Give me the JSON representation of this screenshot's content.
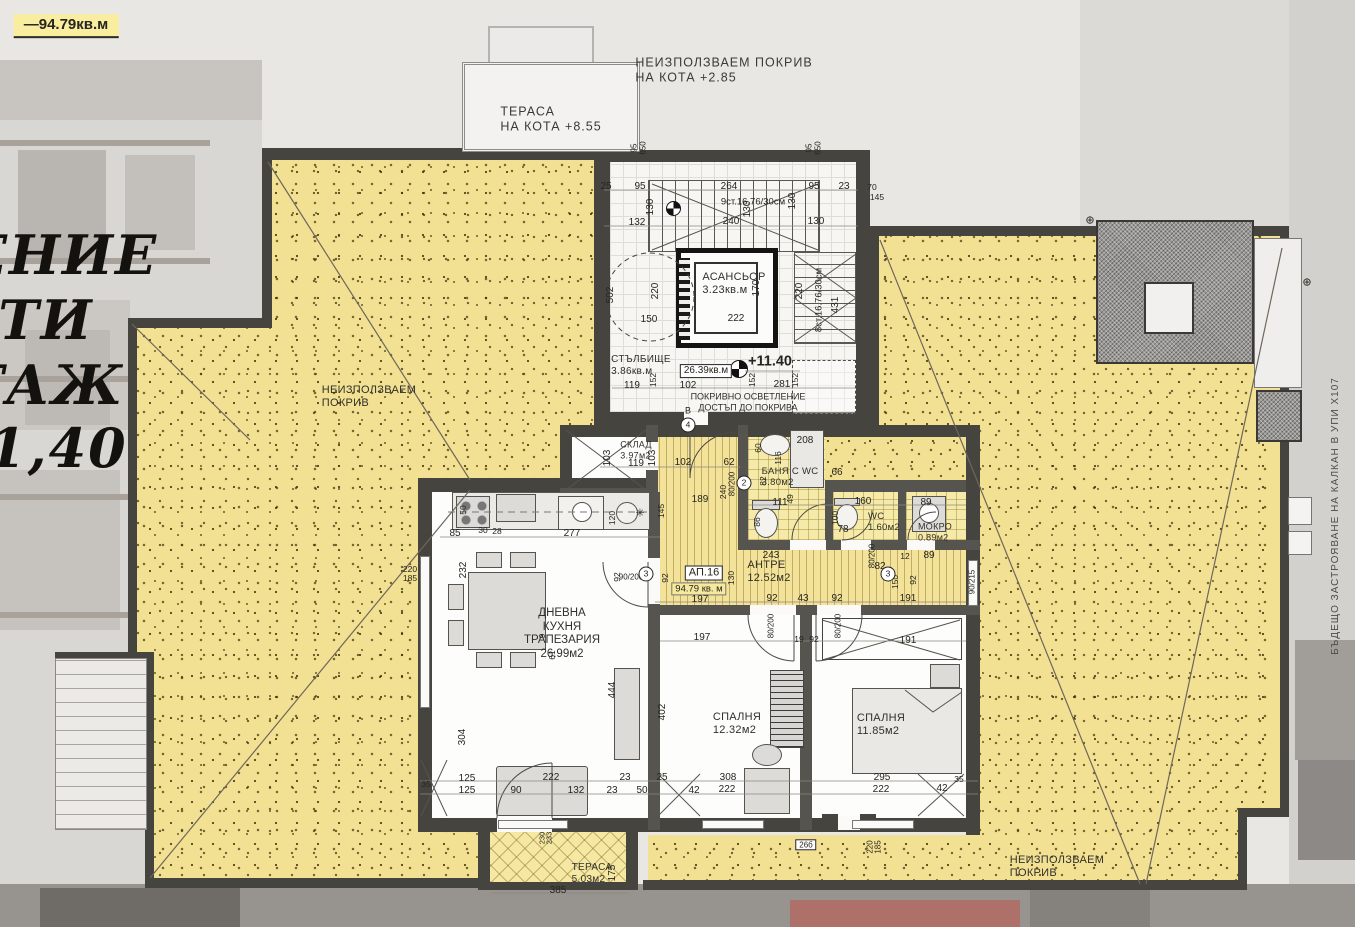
{
  "colors": {
    "roof_yellow": "#f2e193",
    "wall_dark": "#45443e",
    "highlight": "#f9eda0",
    "photo_gray": "#d9d7d4"
  },
  "texts": {
    "site": [
      {
        "t": "—94.79кв.м",
        "x": 66,
        "y": 26,
        "c": "hl",
        "n": "area-note"
      },
      {
        "t": "ЕНИЕ",
        "x": 62,
        "y": 256,
        "c": "big",
        "n": "decorative-text-fragment"
      },
      {
        "t": "ТИ",
        "x": 46,
        "y": 321,
        "c": "big",
        "n": "decorative-text-fragment"
      },
      {
        "t": "ТАЖ",
        "x": 44,
        "y": 386,
        "c": "big",
        "n": "decorative-text-fragment"
      },
      {
        "t": "1,40",
        "x": 58,
        "y": 449,
        "c": "big",
        "n": "decorative-text-fragment"
      },
      {
        "t": "ТЕРАСА\nНА КОТА +8.55",
        "x": 551,
        "y": 119,
        "c": "note",
        "n": "terrace-level-note"
      },
      {
        "t": "НЕИЗПОЛЗВАЕМ  ПОКРИВ\nНА КОТА +2.85",
        "x": 724,
        "y": 70,
        "c": "note",
        "n": "roof-level-note"
      },
      {
        "t": "НЕИЗПОЛЗВАЕМ\nПОКРИВ",
        "x": 369,
        "y": 397,
        "c": "room",
        "n": "roof-label-left"
      },
      {
        "t": "НЕИЗПОЛЗВАЕМ\nПОКРИВ",
        "x": 1057,
        "y": 867,
        "c": "room",
        "n": "roof-label-right"
      },
      {
        "t": "БЪДЕЩО  ЗАСТРОЯВАНЕ  НА  КАЛКАН  В  УПИ  Х107",
        "x": 1336,
        "y": 516,
        "r": -90,
        "c": "dimg",
        "n": "future-construction-note"
      },
      {
        "t": "⊕",
        "x": 1090,
        "y": 221,
        "s": 11
      },
      {
        "t": "⊕",
        "x": 1307,
        "y": 283,
        "s": 11
      }
    ],
    "core": [
      {
        "t": "АСАНСЬОР\n3.23кв.м",
        "x": 734,
        "y": 284,
        "c": "room",
        "n": "room-label-elevator"
      },
      {
        "t": "СТЪЛБИЩЕ\n3.86кв.м",
        "x": 641,
        "y": 366,
        "c": "room",
        "s": 10,
        "n": "room-label-stairs"
      },
      {
        "t": "26.39кв.м",
        "x": 706,
        "y": 371,
        "c": "box",
        "n": "core-area-box"
      },
      {
        "t": "+11.40",
        "x": 770,
        "y": 362,
        "c": "lvltxt",
        "n": "level-mark"
      },
      {
        "t": "ПОКРИВНО  ОСВЕТЛЕНИЕ\nДОСТЪП  ДО  ПОКРИВА",
        "x": 748,
        "y": 402,
        "c": "room-c",
        "s": 9,
        "n": "skylight-note"
      },
      {
        "t": "9ст.16.76/30см",
        "x": 753,
        "y": 202,
        "s": 9.5
      },
      {
        "t": "8ст.16.76/30см",
        "x": 819,
        "y": 300,
        "r": -90,
        "s": 9.5
      },
      {
        "t": "В",
        "x": 688,
        "y": 411,
        "s": 9
      },
      {
        "t": "4",
        "x": 688,
        "y": 425,
        "c": "circle"
      },
      {
        "t": "25",
        "x": 606,
        "y": 187
      },
      {
        "t": "95",
        "x": 640,
        "y": 187
      },
      {
        "t": "264",
        "x": 729,
        "y": 187
      },
      {
        "t": "95",
        "x": 814,
        "y": 187
      },
      {
        "t": "23",
        "x": 844,
        "y": 187
      },
      {
        "t": "70",
        "x": 872,
        "y": 187,
        "s": 8.5
      },
      {
        "t": "145",
        "x": 877,
        "y": 197,
        "s": 8.5
      },
      {
        "t": "130",
        "x": 651,
        "y": 207,
        "r": -90
      },
      {
        "t": "130",
        "x": 748,
        "y": 209,
        "r": -90
      },
      {
        "t": "130",
        "x": 793,
        "y": 201,
        "r": -90
      },
      {
        "t": "132",
        "x": 637,
        "y": 223
      },
      {
        "t": "240",
        "x": 731,
        "y": 222
      },
      {
        "t": "130",
        "x": 816,
        "y": 222
      },
      {
        "t": "95",
        "x": 634,
        "y": 148,
        "r": -90,
        "s": 8
      },
      {
        "t": "650",
        "x": 643,
        "y": 148,
        "r": -90,
        "s": 8
      },
      {
        "t": "95",
        "x": 809,
        "y": 148,
        "r": -90,
        "s": 8
      },
      {
        "t": "650",
        "x": 818,
        "y": 148,
        "r": -90,
        "s": 8
      },
      {
        "t": "502",
        "x": 611,
        "y": 295,
        "r": -90
      },
      {
        "t": "220",
        "x": 656,
        "y": 291,
        "r": -90
      },
      {
        "t": "150",
        "x": 649,
        "y": 320
      },
      {
        "t": "170",
        "x": 757,
        "y": 288,
        "r": -90
      },
      {
        "t": "222",
        "x": 736,
        "y": 319
      },
      {
        "t": "220",
        "x": 800,
        "y": 291,
        "r": -90
      },
      {
        "t": "431",
        "x": 836,
        "y": 305,
        "r": -90
      },
      {
        "t": "119",
        "x": 632,
        "y": 386
      },
      {
        "t": "102",
        "x": 688,
        "y": 386
      },
      {
        "t": "281",
        "x": 782,
        "y": 385
      },
      {
        "t": "152",
        "x": 653,
        "y": 380,
        "r": -90,
        "s": 8.5
      },
      {
        "t": "152",
        "x": 752,
        "y": 380,
        "r": -90,
        "s": 8.5
      },
      {
        "t": "152",
        "x": 795,
        "y": 380,
        "r": -90,
        "s": 8.5
      }
    ],
    "rooms": [
      {
        "t": "АП.16",
        "x": 704,
        "y": 573,
        "c": "box",
        "s": 11,
        "n": "apartment-id"
      },
      {
        "t": "94.79 кв. м",
        "x": 699,
        "y": 589,
        "c": "hl2",
        "n": "apartment-area"
      },
      {
        "t": "АНТРЕ\n12.52м2",
        "x": 769,
        "y": 572,
        "c": "room",
        "n": "room-label-hall"
      },
      {
        "t": "ДНЕВНА\nКУХНЯ\nТРАПЕЗАРИЯ\n26.99м2",
        "x": 562,
        "y": 634,
        "c": "room-c",
        "s": 11.5,
        "n": "room-label-living-kitchen"
      },
      {
        "t": "СПАЛНЯ\n12.32м2",
        "x": 737,
        "y": 724,
        "c": "room",
        "n": "room-label-bedroom-1"
      },
      {
        "t": "СПАЛНЯ\n11.85м2",
        "x": 881,
        "y": 725,
        "c": "room",
        "n": "room-label-bedroom-2"
      },
      {
        "t": "БАНЯ С WC\n3.80м2",
        "x": 790,
        "y": 477,
        "c": "room",
        "s": 9.5,
        "n": "room-label-bath"
      },
      {
        "t": "WC\n1.60м2",
        "x": 884,
        "y": 522,
        "c": "room",
        "s": 9.5,
        "n": "room-label-wc"
      },
      {
        "t": "МОКРО\n0.89м2",
        "x": 935,
        "y": 532,
        "c": "room",
        "s": 9,
        "n": "room-label-laundry"
      },
      {
        "t": "СКЛАД\n3.97м2",
        "x": 636,
        "y": 450,
        "c": "room",
        "s": 9,
        "n": "room-label-storage"
      },
      {
        "t": "ТЕРАСА\n5.03м2",
        "x": 592,
        "y": 874,
        "c": "room",
        "s": 10,
        "n": "room-label-terrace"
      },
      {
        "t": "26б",
        "x": 806,
        "y": 845,
        "c": "box",
        "s": 8,
        "n": "element-tag"
      }
    ],
    "dims": [
      {
        "t": "103",
        "x": 608,
        "y": 458,
        "r": -90
      },
      {
        "t": "103",
        "x": 653,
        "y": 458,
        "r": -90
      },
      {
        "t": "119",
        "x": 636,
        "y": 464
      },
      {
        "t": "102",
        "x": 683,
        "y": 463
      },
      {
        "t": "62",
        "x": 729,
        "y": 463
      },
      {
        "t": "189",
        "x": 700,
        "y": 500
      },
      {
        "t": "145",
        "x": 661,
        "y": 511,
        "r": -90,
        "s": 8.5
      },
      {
        "t": "240",
        "x": 723,
        "y": 492,
        "r": -90,
        "s": 8.5
      },
      {
        "t": "80/200",
        "x": 732,
        "y": 484,
        "r": -90,
        "s": 8
      },
      {
        "t": "208",
        "x": 805,
        "y": 441
      },
      {
        "t": "60",
        "x": 758,
        "y": 448,
        "r": -90,
        "s": 8.5
      },
      {
        "t": "116",
        "x": 778,
        "y": 458,
        "r": -90,
        "s": 8.5
      },
      {
        "t": "66",
        "x": 837,
        "y": 473
      },
      {
        "t": "82",
        "x": 763,
        "y": 481,
        "r": -90,
        "s": 8.5
      },
      {
        "t": "111",
        "x": 780,
        "y": 503
      },
      {
        "t": "49",
        "x": 790,
        "y": 499,
        "r": -90,
        "s": 8.5
      },
      {
        "t": "86",
        "x": 757,
        "y": 522,
        "r": -90,
        "s": 8.5
      },
      {
        "t": "160",
        "x": 863,
        "y": 502
      },
      {
        "t": "100",
        "x": 835,
        "y": 518,
        "r": -90,
        "s": 8.5
      },
      {
        "t": "78",
        "x": 843,
        "y": 530
      },
      {
        "t": "89",
        "x": 926,
        "y": 503
      },
      {
        "t": "89",
        "x": 929,
        "y": 556
      },
      {
        "t": "12",
        "x": 905,
        "y": 556,
        "s": 8.5
      },
      {
        "t": "80/200",
        "x": 872,
        "y": 556,
        "r": -90,
        "s": 8
      },
      {
        "t": "82",
        "x": 880,
        "y": 567
      },
      {
        "t": "150",
        "x": 895,
        "y": 582,
        "r": -90,
        "s": 8.5
      },
      {
        "t": "92",
        "x": 913,
        "y": 580,
        "r": -90,
        "s": 8.5
      },
      {
        "t": "191",
        "x": 908,
        "y": 599
      },
      {
        "t": "191",
        "x": 908,
        "y": 641
      },
      {
        "t": "90/215",
        "x": 972,
        "y": 582,
        "r": -90,
        "s": 8
      },
      {
        "t": "243",
        "x": 771,
        "y": 556
      },
      {
        "t": "92",
        "x": 665,
        "y": 578,
        "r": -90,
        "s": 8.5
      },
      {
        "t": "130",
        "x": 731,
        "y": 578,
        "r": -90,
        "s": 8.5
      },
      {
        "t": "197",
        "x": 700,
        "y": 600
      },
      {
        "t": "92",
        "x": 772,
        "y": 599
      },
      {
        "t": "43",
        "x": 803,
        "y": 599
      },
      {
        "t": "92",
        "x": 837,
        "y": 599
      },
      {
        "t": "80/200",
        "x": 771,
        "y": 626,
        "r": -90,
        "s": 8
      },
      {
        "t": "80/200",
        "x": 838,
        "y": 626,
        "r": -90,
        "s": 8
      },
      {
        "t": "197",
        "x": 702,
        "y": 638
      },
      {
        "t": "19",
        "x": 799,
        "y": 639,
        "s": 8.5
      },
      {
        "t": "92",
        "x": 814,
        "y": 639,
        "s": 8.5
      },
      {
        "t": "92",
        "x": 617,
        "y": 577,
        "r": -90,
        "s": 8.5
      },
      {
        "t": "90/200",
        "x": 631,
        "y": 577,
        "s": 8
      },
      {
        "t": "3",
        "x": 646,
        "y": 574,
        "c": "circle"
      },
      {
        "t": "3",
        "x": 888,
        "y": 574,
        "c": "circle"
      },
      {
        "t": "2",
        "x": 744,
        "y": 483,
        "c": "circle"
      },
      {
        "t": "85",
        "x": 455,
        "y": 534
      },
      {
        "t": "30",
        "x": 483,
        "y": 530,
        "s": 8.5
      },
      {
        "t": "28",
        "x": 497,
        "y": 531,
        "s": 8.5
      },
      {
        "t": "277",
        "x": 572,
        "y": 534
      },
      {
        "t": "120",
        "x": 612,
        "y": 518,
        "r": -90,
        "s": 8.5
      },
      {
        "t": "50",
        "x": 463,
        "y": 510,
        "r": -90,
        "s": 8.5
      },
      {
        "t": "✳",
        "x": 640,
        "y": 514,
        "s": 11
      },
      {
        "t": "220",
        "x": 410,
        "y": 569,
        "s": 8.5
      },
      {
        "t": "185",
        "x": 410,
        "y": 578,
        "s": 8.5
      },
      {
        "t": "232",
        "x": 464,
        "y": 570,
        "r": -90
      },
      {
        "t": "9",
        "x": 542,
        "y": 636,
        "r": -90,
        "s": 8.5
      },
      {
        "t": "61",
        "x": 552,
        "y": 655,
        "r": -90,
        "s": 8.5
      },
      {
        "t": "304",
        "x": 463,
        "y": 737,
        "r": -90
      },
      {
        "t": "444",
        "x": 613,
        "y": 690,
        "r": -90
      },
      {
        "t": "402",
        "x": 663,
        "y": 712,
        "r": -90
      },
      {
        "t": "35",
        "x": 426,
        "y": 784,
        "s": 8.5
      },
      {
        "t": "125",
        "x": 467,
        "y": 779
      },
      {
        "t": "125",
        "x": 467,
        "y": 791
      },
      {
        "t": "90",
        "x": 516,
        "y": 791
      },
      {
        "t": "222",
        "x": 551,
        "y": 778
      },
      {
        "t": "132",
        "x": 576,
        "y": 791
      },
      {
        "t": "23",
        "x": 625,
        "y": 778
      },
      {
        "t": "23",
        "x": 612,
        "y": 791
      },
      {
        "t": "50",
        "x": 642,
        "y": 791
      },
      {
        "t": "25",
        "x": 662,
        "y": 778
      },
      {
        "t": "42",
        "x": 694,
        "y": 791
      },
      {
        "t": "308",
        "x": 728,
        "y": 778
      },
      {
        "t": "222",
        "x": 727,
        "y": 790
      },
      {
        "t": "295",
        "x": 882,
        "y": 778
      },
      {
        "t": "222",
        "x": 881,
        "y": 790
      },
      {
        "t": "42",
        "x": 942,
        "y": 789
      },
      {
        "t": "35",
        "x": 959,
        "y": 779,
        "s": 8.5
      },
      {
        "t": "220",
        "x": 870,
        "y": 847,
        "r": -90,
        "s": 8
      },
      {
        "t": "185",
        "x": 878,
        "y": 847,
        "r": -90,
        "s": 8
      },
      {
        "t": "385",
        "x": 558,
        "y": 891
      },
      {
        "t": "175",
        "x": 613,
        "y": 873,
        "r": -90
      },
      {
        "t": "230",
        "x": 543,
        "y": 838,
        "r": -90,
        "s": 7.5
      },
      {
        "t": "233",
        "x": 550,
        "y": 838,
        "r": -90,
        "s": 7.5
      }
    ]
  }
}
